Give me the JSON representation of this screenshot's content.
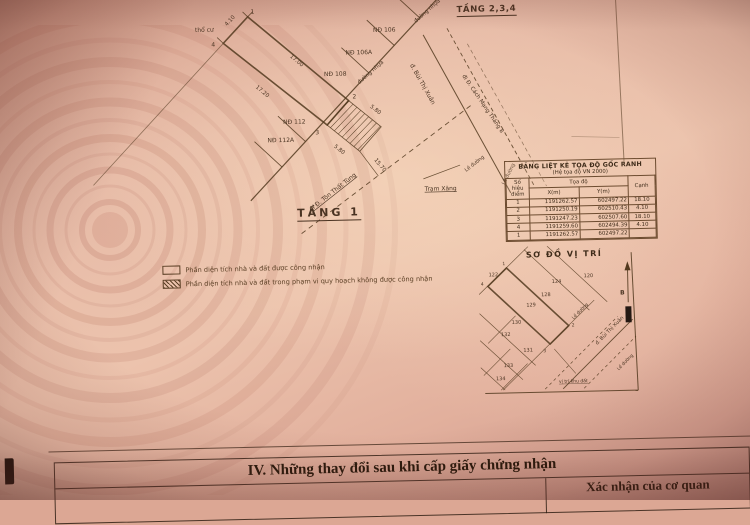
{
  "drawing": {
    "floor_234": "TẦNG 2,3,4",
    "floor_1": "TẦNG 1",
    "land_type": "thổ cư",
    "road_surface": "đường nhựa",
    "points": {
      "p1": "1",
      "p2": "2",
      "p3": "3",
      "p4": "4"
    },
    "dims": {
      "top": "4.10",
      "right": "17.00",
      "left": "17.20",
      "ext_right": "5.80",
      "ext_left": "5.80",
      "setback": "15.70"
    },
    "neighbors": [
      "NĐ 106",
      "NĐ 106A",
      "NĐ 108",
      "NĐ 112",
      "NĐ 112A"
    ],
    "streets": {
      "to_ton_that_tung": "đi Đ. Tôn Thất Tùng",
      "bui_thi_xuan": "đ. Bùi Thị Xuân",
      "to_cach_mang_thang_8": "đi Đ. Cách Mạng Tháng 8",
      "gas_station": "Trạm Xăng",
      "sidewalk": "Lề đường"
    }
  },
  "coord_table": {
    "title": "BẢNG LIỆT KÊ TỌA ĐỘ GỐC RANH",
    "subtitle": "(Hệ tọa độ VN 2000)",
    "headers": {
      "point": "Số hiệu điểm",
      "coord": "Tọa độ",
      "x": "X(m)",
      "y": "Y(m)",
      "edge": "Cạnh"
    },
    "rows": [
      [
        "1",
        "1191262.57",
        "602497.22",
        "18.10"
      ],
      [
        "2",
        "1191250.19",
        "602510.43",
        "4.10"
      ],
      [
        "3",
        "1191247.23",
        "602507.60",
        "18.10"
      ],
      [
        "4",
        "1191259.60",
        "602494.39",
        "4.10"
      ],
      [
        "1",
        "1191262.57",
        "602497.22",
        ""
      ]
    ]
  },
  "legend": {
    "recognized": "Phần diện tích nhà và đất được công nhận",
    "not_recognized": "Phần diện tích nhà và đất trong phạm vi quy hoạch không được công nhận"
  },
  "location_map": {
    "title": "SƠ ĐỒ VỊ TRÍ",
    "parcels": [
      "122",
      "124",
      "120",
      "128",
      "129",
      "130",
      "132",
      "131",
      "133",
      "134"
    ],
    "corners": {
      "c1": "1",
      "c2": "2",
      "c3": "3",
      "c4": "4"
    },
    "street": "đ. Bùi Thị Xuân",
    "sidewalk_upper": "Lề đường",
    "sidewalk_lower": "Lề đường",
    "site_label": "vị trí khu đất",
    "north": "B"
  },
  "section_iv": {
    "title": "IV. Những thay đổi sau khi cấp giấy chứng nhận",
    "confirm_header": "Xác nhận của cơ quan"
  },
  "colors": {
    "paper": "#e6b5a2",
    "ink": "#52391f",
    "text_dark": "#241709"
  }
}
